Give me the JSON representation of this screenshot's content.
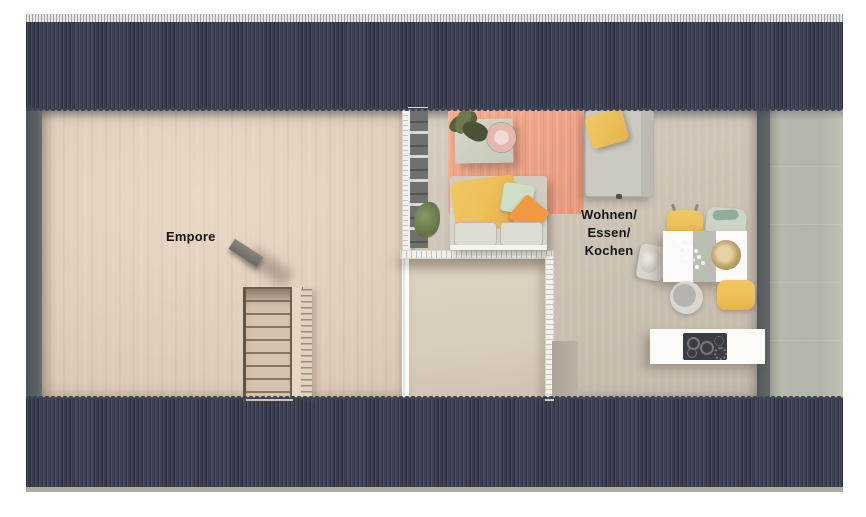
{
  "plan": {
    "title": "Dachgeschoss Grundriss",
    "labels": {
      "empore": "Empore",
      "living": {
        "line1": "Wohnen/",
        "line2": "Essen/",
        "line3": "Kochen"
      }
    },
    "colors": {
      "roof": "#3e4356",
      "ridge": "#e3e3e0",
      "wall_dark": "#575b5e",
      "floor_empore": "#dfcdba",
      "floor_living": "#ccc3b5",
      "small_room": "#d9cdbc",
      "outdoor": "#b3b5aa",
      "eave": "#aaad9f",
      "rug": "#eea285",
      "sofa": "#d7d4cb",
      "accent_yellow": "#edc058",
      "accent_orange": "#ef9a41",
      "accent_mint": "#cfdec6",
      "table_white": "#fbfaf7",
      "cooktop": "#3a3d41",
      "stair_tread": "#d6c3ad",
      "label": "#151515"
    },
    "furniture": [
      "staircase",
      "shelf",
      "rug",
      "coffee-table",
      "plant",
      "sofa",
      "armchair",
      "dining-table",
      "dining-chairs",
      "stool",
      "kitchen-island",
      "cooktop"
    ]
  }
}
